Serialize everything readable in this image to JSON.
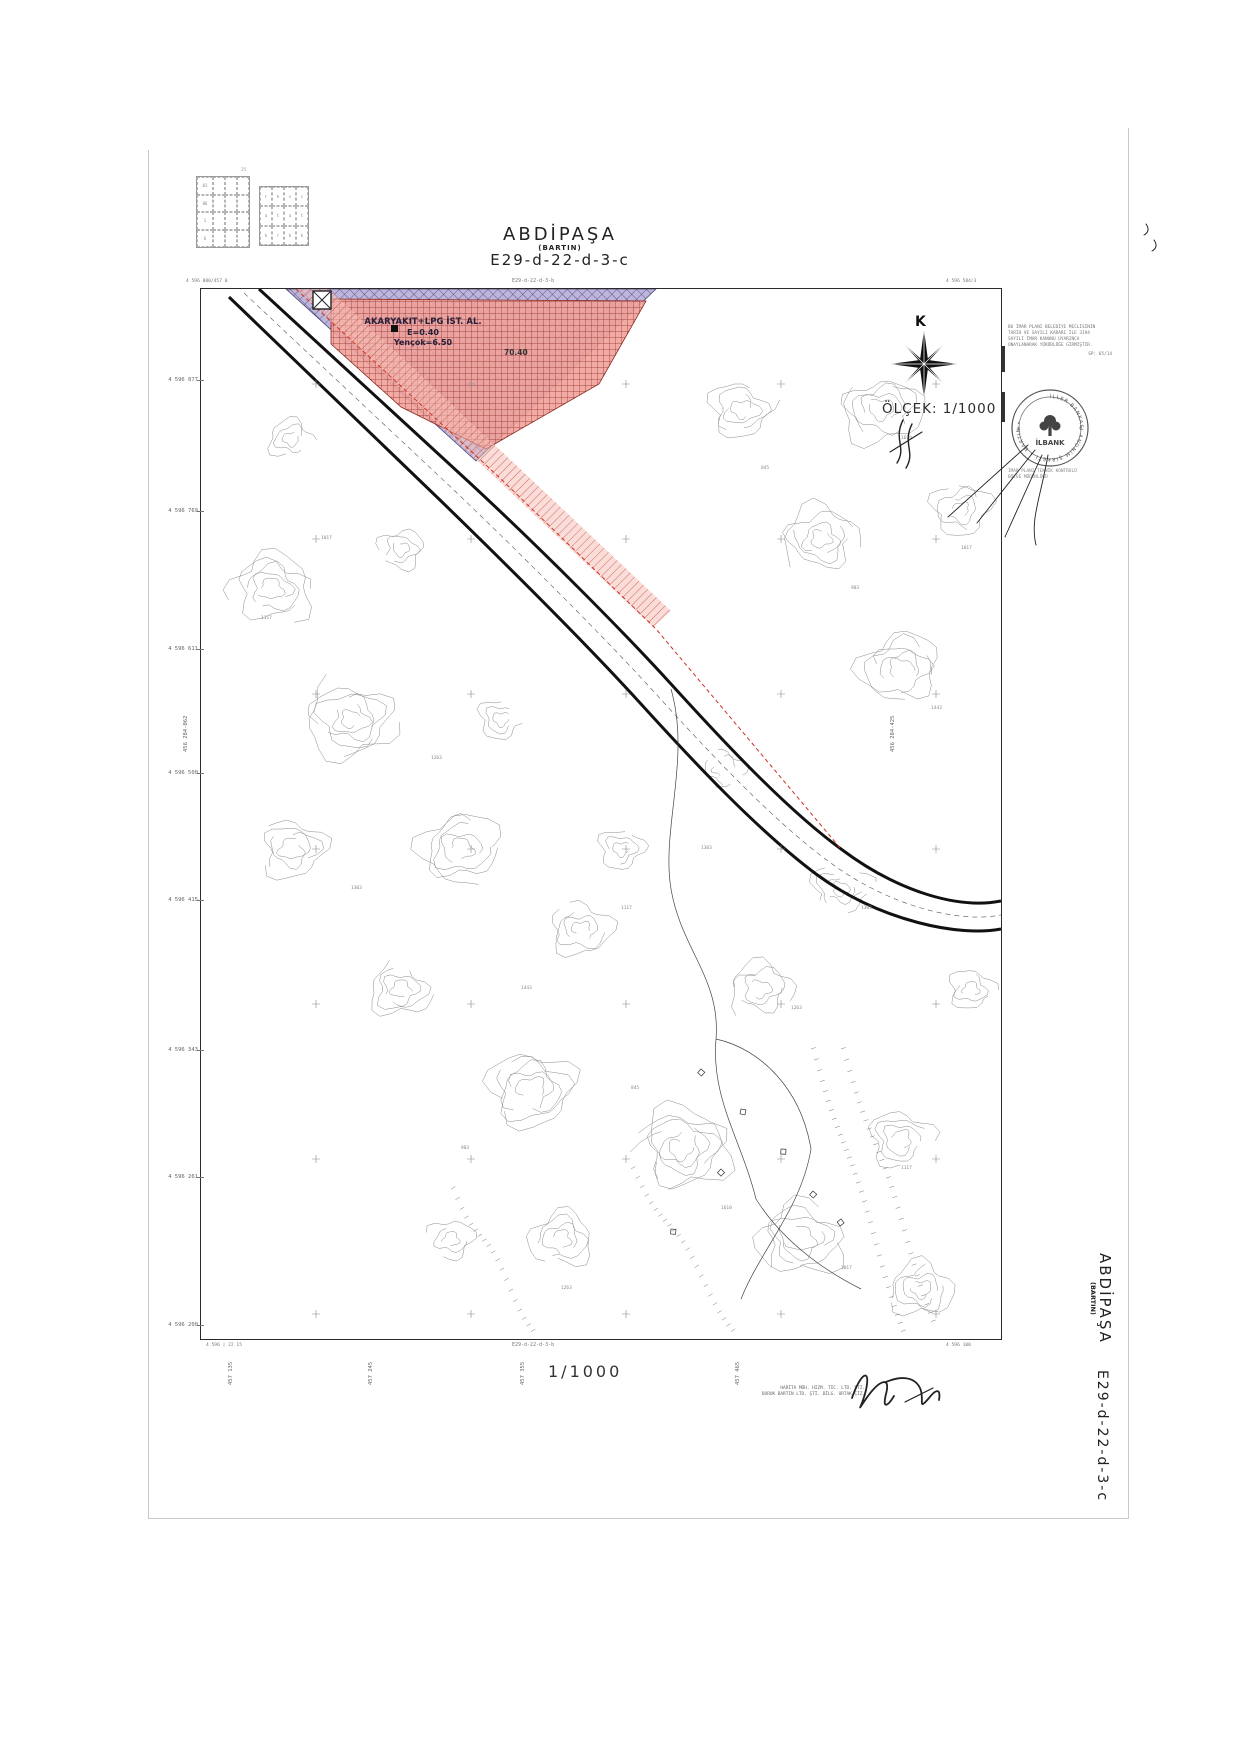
{
  "header": {
    "title": "ABDİPAŞA",
    "region": "(BARTIN)",
    "sheet": "E29-d-22-d-3-c"
  },
  "map": {
    "north_label": "K",
    "scale_label": "ÖLÇEK: 1/1000",
    "adjacent_sheet_top": "E29-d-22-d-3-b",
    "adjacent_sheet_bottom": "E29-d-22-d-3-b",
    "corner_top_left": "4 596 880/457 0",
    "corner_top_right": "4 596 584/3",
    "corner_bottom_left_outer": "4 596 | 22 15",
    "corner_bottom_right": "4 596 100",
    "left_ticks": [
      {
        "y": 380,
        "label": "4 596 877"
      },
      {
        "y": 511,
        "label": "4 596 769"
      },
      {
        "y": 649,
        "label": "4 596 611"
      },
      {
        "y": 773,
        "label": "4 596 500"
      },
      {
        "y": 900,
        "label": "4 596 415"
      },
      {
        "y": 1050,
        "label": "4 596 343"
      },
      {
        "y": 1177,
        "label": "4 596 261"
      },
      {
        "y": 1325,
        "label": "4 596 200"
      }
    ],
    "bottom_ticks": [
      {
        "x": 228,
        "label": "457 135"
      },
      {
        "x": 368,
        "label": "457 245"
      },
      {
        "x": 520,
        "label": "457 355"
      },
      {
        "x": 735,
        "label": "457 465"
      }
    ],
    "side_label_left": "456 284-062",
    "side_label_right": "456 284-425",
    "zone": {
      "line1": "AKARYAKIT+LPG İST. AL.",
      "line2": "E=0.40",
      "line3": "Yençok=6.50",
      "dim_label": "70.40"
    },
    "contour_labels": [
      "1017",
      "1117",
      "1263",
      "1303",
      "1443",
      "903",
      "845",
      "1610"
    ]
  },
  "index": {
    "note": "25",
    "grid_a_rows": [
      "01",
      "06",
      "1",
      "6"
    ],
    "grid_b_cells": [
      "r",
      "k",
      "s",
      "c",
      "a",
      "t",
      "a",
      "t",
      "k",
      "r",
      "b",
      "k"
    ]
  },
  "approval": {
    "lines": [
      "BU İMAR PLANI BELEDİYE MECLİSİNİN",
      "TARİH VE SAYILI KARARI İLE 3194",
      "SAYILI İMAR KANUNU UYARINCA",
      "ONAYLANARAK YÜRÜRLÜĞE GİRMİŞTİR."
    ],
    "ref": "SP: 65/14"
  },
  "stamp": {
    "ring_text": "İLLER BANKASI ANONİM ŞİRKETİ • BARTIN •",
    "center_text": "İLBANK"
  },
  "stamp_note": [
    "İMAR PLANI TEKNİK KONTROLÜ",
    "BÖLGE MÜDÜRLÜĞÜ"
  ],
  "footer": {
    "scale": "1/1000",
    "credit1": "HARİTA MÜH. HİZM. TİC. LTD. ŞTİ.",
    "credit2": "DORUK BARTIN LTD. ŞTİ. BİLG. ORTAK ÇİZ."
  },
  "side_title": {
    "title": "ABDİPAŞA",
    "region": "(BARTIN)",
    "sheet": "E29-d-22-d-3-c"
  },
  "colors": {
    "zone_purple": "#b3a8d8",
    "zone_red": "#f0a29a",
    "boundary_red": "#cc3322",
    "ink": "#1c1c1c"
  }
}
